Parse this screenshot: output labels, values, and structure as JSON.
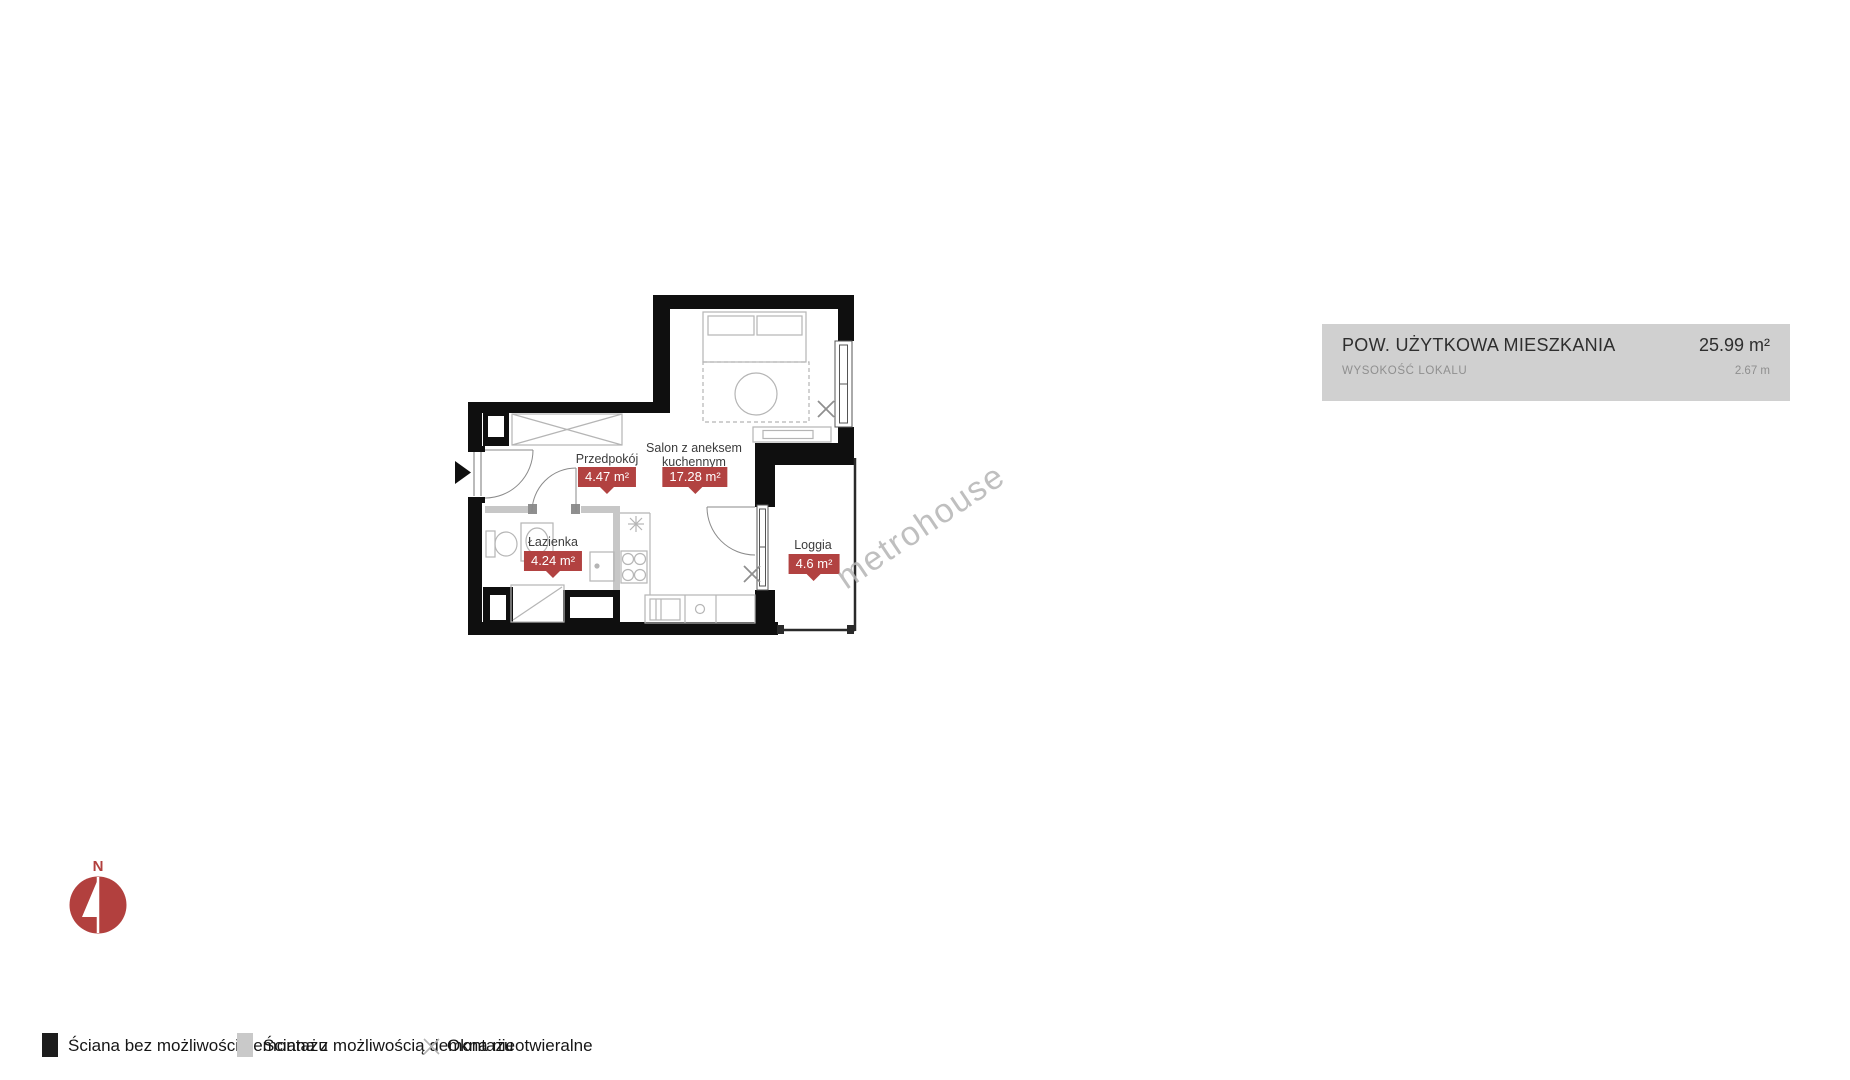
{
  "info_box": {
    "title": "POW. UŻYTKOWA MIESZKANIA",
    "area_value": "25.99 m²",
    "height_label": "WYSOKOŚĆ LOKALU",
    "height_value": "2.67 m"
  },
  "rooms": {
    "przedpokoj": {
      "name": "Przedpokój",
      "area": "4.47 m²"
    },
    "salon": {
      "name_line1": "Salon z aneksem",
      "name_line2": "kuchennym",
      "area": "17.28 m²"
    },
    "lazienka": {
      "name": "Łazienka",
      "area": "4.24 m²"
    },
    "loggia": {
      "name": "Loggia",
      "area": "4.6 m²"
    }
  },
  "legend": [
    {
      "symbol": "black-square",
      "label": "Ściana bez możliwości demontażu"
    },
    {
      "symbol": "gray-square",
      "label": "Ściana z możliwością demontażu"
    },
    {
      "symbol": "x-mark",
      "label": "Okna nieotwieralne"
    }
  ],
  "compass": {
    "north_label": "N"
  },
  "watermark": "metrohouse",
  "colors": {
    "accent_red": "#b24241",
    "wall_black": "#0f0f0f",
    "wall_gray": "#c7c7c7",
    "panel_gray": "#d0d0d0"
  }
}
